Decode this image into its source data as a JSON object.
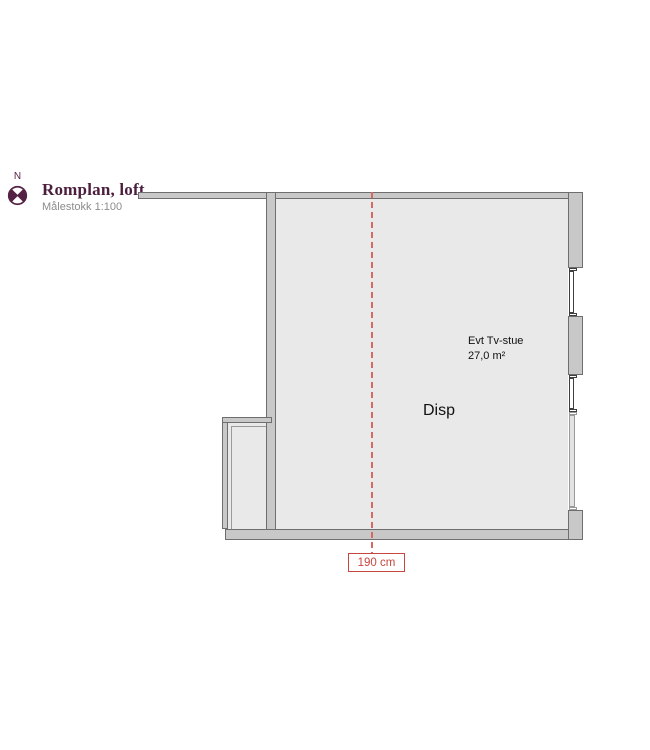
{
  "header": {
    "title": "Romplan, loft",
    "subtitle": "Målestokk 1:100",
    "compass_label": "N"
  },
  "plan": {
    "room_label": "Disp",
    "unit_name": "Evt Tv-stue",
    "unit_area": "27,0 m²",
    "dimension_label": "190 cm",
    "colors": {
      "title_plum": "#4b1e3d",
      "compass_plum": "#542244",
      "wall_fill": "#c8c8c8",
      "wall_edge": "#6e6e6e",
      "interior_fill": "#e9e9e9",
      "dimension_red": "#c7463d",
      "dashed_line_red": "#d4695f"
    }
  }
}
